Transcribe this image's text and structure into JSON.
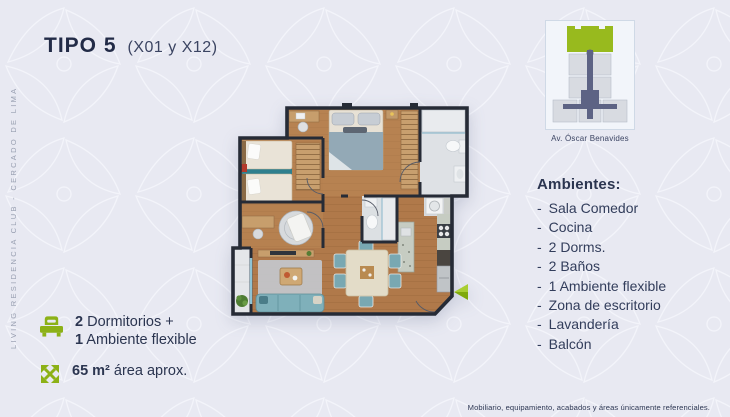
{
  "title": {
    "main": "TIPO 5",
    "sub": "(X01 y X12)"
  },
  "side_label": "LIVING RESIDENCIA CLUB - CERCADO DE LIMA",
  "key_plan": {
    "street_label": "Av. Óscar Benavides"
  },
  "ambientes": {
    "heading": "Ambientes:",
    "dash": "-",
    "items": [
      "Sala Comedor",
      "Cocina",
      "2 Dorms.",
      "2 Baños",
      "1 Ambiente flexible",
      "Zona de escritorio",
      "Lavandería",
      "Balcón"
    ]
  },
  "features": {
    "bedrooms_line1_num": "2",
    "bedrooms_line1_text": " Dormitorios +",
    "bedrooms_line2_num": "1",
    "bedrooms_line2_text": " Ambiente flexible",
    "area_num": "65 m²",
    "area_text": " área aprox."
  },
  "disclaimer": "Mobiliario, equipamiento, acabados y áreas únicamente referenciales.",
  "colors": {
    "accent_green": "#8cb117",
    "navy": "#2b3550",
    "walls": "#262b36",
    "background": "#e8e9f2"
  }
}
